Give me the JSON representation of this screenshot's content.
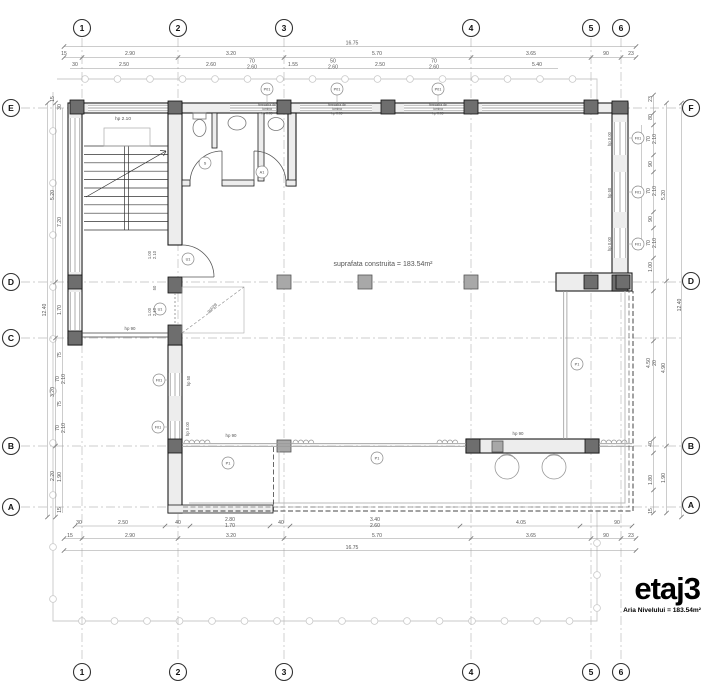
{
  "title_block": {
    "title": "etaj3",
    "subtitle": "Aria Nivelului = 183.54m²"
  },
  "area_note": "suprafata construita = 183.54m²",
  "grid_bubbles": {
    "cols": [
      {
        "label": "1",
        "x": 82
      },
      {
        "label": "2",
        "x": 178
      },
      {
        "label": "3",
        "x": 284
      },
      {
        "label": "4",
        "x": 471
      },
      {
        "label": "5",
        "x": 591
      },
      {
        "label": "6",
        "x": 621
      }
    ],
    "rows_left": [
      {
        "label": "E",
        "y": 108
      },
      {
        "label": "D",
        "y": 282
      },
      {
        "label": "C",
        "y": 338
      },
      {
        "label": "B",
        "y": 446
      },
      {
        "label": "A",
        "y": 507
      }
    ],
    "rows_right": [
      {
        "label": "F",
        "y": 108
      },
      {
        "label": "D",
        "y": 281
      },
      {
        "label": "B",
        "y": 446
      },
      {
        "label": "A",
        "y": 505
      }
    ]
  },
  "dimensions": {
    "top": [
      {
        "t": "16.75",
        "x": 352,
        "y": 44.5
      },
      {
        "t": "15",
        "x": 64,
        "y": 55
      },
      {
        "t": "2.90",
        "x": 130,
        "y": 55
      },
      {
        "t": "3.20",
        "x": 231,
        "y": 55
      },
      {
        "t": "5.70",
        "x": 377,
        "y": 55
      },
      {
        "t": "3.65",
        "x": 531,
        "y": 55
      },
      {
        "t": "90",
        "x": 606,
        "y": 55
      },
      {
        "t": "23",
        "x": 631,
        "y": 55
      },
      {
        "t": "30",
        "x": 75,
        "y": 66
      },
      {
        "t": "2.50",
        "x": 124,
        "y": 66
      },
      {
        "t": "2.60",
        "x": 211,
        "y": 66
      },
      {
        "t": "70",
        "t2": "2.60",
        "x": 252,
        "y": 62.5
      },
      {
        "t": "1.55",
        "x": 293,
        "y": 66
      },
      {
        "t": "50",
        "t2": "2.60",
        "x": 333,
        "y": 62.5
      },
      {
        "t": "2.50",
        "x": 380,
        "y": 66
      },
      {
        "t": "70",
        "t2": "2.60",
        "x": 434,
        "y": 62.5
      },
      {
        "t": "5.40",
        "x": 537,
        "y": 66
      }
    ],
    "bottom": [
      {
        "t": "30",
        "x": 79,
        "y": 524
      },
      {
        "t": "2.50",
        "x": 123,
        "y": 524
      },
      {
        "t": "40",
        "x": 178,
        "y": 524
      },
      {
        "t": "2.80",
        "t2": "1.70",
        "x": 230,
        "y": 521
      },
      {
        "t": "40",
        "x": 281,
        "y": 524
      },
      {
        "t": "3.40",
        "t2": "2.60",
        "x": 375,
        "y": 521
      },
      {
        "t": "4.05",
        "x": 521,
        "y": 524
      },
      {
        "t": "90",
        "x": 617,
        "y": 524
      },
      {
        "t": "15",
        "x": 70,
        "y": 537
      },
      {
        "t": "2.90",
        "x": 130,
        "y": 537
      },
      {
        "t": "3.20",
        "x": 231,
        "y": 537
      },
      {
        "t": "5.70",
        "x": 377,
        "y": 537
      },
      {
        "t": "3.65",
        "x": 531,
        "y": 537
      },
      {
        "t": "90",
        "x": 606,
        "y": 537
      },
      {
        "t": "23",
        "x": 631,
        "y": 537
      },
      {
        "t": "16.75",
        "x": 352,
        "y": 549
      }
    ],
    "left": [
      {
        "t": "12.40",
        "x": 46,
        "y": 310,
        "r": -90
      },
      {
        "t": "5.20",
        "x": 54,
        "y": 195,
        "r": -90
      },
      {
        "t": "3.20",
        "x": 54,
        "y": 392,
        "r": -90
      },
      {
        "t": "2.20",
        "x": 54,
        "y": 476,
        "r": -90
      },
      {
        "t": "15",
        "x": 54,
        "y": 99,
        "r": -90
      },
      {
        "t": "30",
        "x": 61,
        "y": 107,
        "r": -90
      },
      {
        "t": "7.20",
        "x": 61,
        "y": 222,
        "r": -90
      },
      {
        "t": "1.70",
        "x": 61,
        "y": 310,
        "r": -90
      },
      {
        "t": "75",
        "x": 61,
        "y": 355,
        "r": -90
      },
      {
        "t": "70",
        "t2": "2.10",
        "x": 59,
        "y": 379,
        "r": -90
      },
      {
        "t": "75",
        "x": 61,
        "y": 404,
        "r": -90
      },
      {
        "t": "70",
        "t2": "2.10",
        "x": 59,
        "y": 428,
        "r": -90
      },
      {
        "t": "1.90",
        "x": 61,
        "y": 477,
        "r": -90
      },
      {
        "t": "15",
        "x": 61,
        "y": 510,
        "r": -90
      }
    ],
    "right": [
      {
        "t": "12.40",
        "x": 681,
        "y": 305,
        "r": -90
      },
      {
        "t": "5.20",
        "x": 665,
        "y": 195,
        "r": -90
      },
      {
        "t": "4.90",
        "x": 665,
        "y": 368,
        "r": -90
      },
      {
        "t": "1.90",
        "x": 665,
        "y": 478,
        "r": -90
      },
      {
        "t": "3.20",
        "x": 641,
        "y": 192,
        "r": -90
      },
      {
        "t": "23",
        "x": 652,
        "y": 99,
        "r": -90
      },
      {
        "t": "80",
        "x": 652,
        "y": 117,
        "r": -90
      },
      {
        "t": "70",
        "t2": "2.10",
        "x": 650,
        "y": 139,
        "r": -90
      },
      {
        "t": "90",
        "x": 652,
        "y": 164,
        "r": -90
      },
      {
        "t": "70",
        "t2": "2.10",
        "x": 650,
        "y": 191,
        "r": -90
      },
      {
        "t": "90",
        "x": 652,
        "y": 219,
        "r": -90
      },
      {
        "t": "70",
        "t2": "2.10",
        "x": 650,
        "y": 243,
        "r": -90
      },
      {
        "t": "1.00",
        "x": 652,
        "y": 267,
        "r": -90
      },
      {
        "t": "4.50",
        "t2": "20",
        "x": 650,
        "y": 363,
        "r": -90
      },
      {
        "t": "40",
        "x": 652,
        "y": 444,
        "r": -90
      },
      {
        "t": "1.80",
        "x": 652,
        "y": 480,
        "r": -90
      },
      {
        "t": "15",
        "x": 652,
        "y": 511,
        "r": -90
      }
    ]
  },
  "annotations": [
    {
      "t": "hp 2.10",
      "x": 123,
      "y": 120
    },
    {
      "t": "hp 90",
      "x": 130,
      "y": 330,
      "s": 4.4
    },
    {
      "t": "hp 90",
      "x": 231,
      "y": 437,
      "s": 4.4
    },
    {
      "t": "hp 90",
      "x": 518,
      "y": 435,
      "s": 4.4
    },
    {
      "t": "hp 0.00",
      "x": 611,
      "y": 139,
      "r": -90,
      "s": 4.2
    },
    {
      "t": "hp 50",
      "x": 611,
      "y": 193,
      "r": -90,
      "s": 4.2
    },
    {
      "t": "hp 0.00",
      "x": 611,
      "y": 244,
      "r": -90,
      "s": 4.2
    },
    {
      "t": "hp 50",
      "x": 190,
      "y": 381,
      "r": -90,
      "s": 4.2
    },
    {
      "t": "hp 0.00",
      "x": 189,
      "y": 429,
      "r": -90,
      "s": 4.2
    },
    {
      "t": "1.00",
      "t2": "2.10",
      "x": 151,
      "y": 255,
      "r": -90,
      "s": 4.2
    },
    {
      "t": "50",
      "x": 156,
      "y": 288,
      "r": -90,
      "s": 4.2
    },
    {
      "t": "1.00",
      "t2": "2.10",
      "x": 151,
      "y": 312,
      "r": -90,
      "s": 4.2
    },
    {
      "t": "gol/2B",
      "x": 213,
      "y": 309,
      "r": -42,
      "s": 4.2
    },
    {
      "t": "suprafata construita = 183.54m²",
      "x": 383,
      "y": 266,
      "s": 7
    },
    {
      "t": "fereastra de",
      "t2": "lumina",
      "t3": "hp 0.05",
      "x": 267,
      "y": 106,
      "s": 3.3
    },
    {
      "t": "fereastra de",
      "t2": "lumina",
      "t3": "hp 0.05",
      "x": 337,
      "y": 106,
      "s": 3.3
    },
    {
      "t": "fereastra de",
      "t2": "lumina",
      "t3": "hp 0.05",
      "x": 438,
      "y": 106,
      "s": 3.3
    }
  ],
  "tags": [
    {
      "code": "P01",
      "x": 267,
      "y": 89,
      "ld": [
        267,
        95,
        267,
        103
      ]
    },
    {
      "code": "P01",
      "x": 337,
      "y": 89,
      "ld": [
        337,
        95,
        337,
        103
      ]
    },
    {
      "code": "P01",
      "x": 438,
      "y": 89,
      "ld": [
        438,
        95,
        438,
        103
      ]
    },
    {
      "code": "F01",
      "x": 638,
      "y": 138,
      "ld": [
        632,
        138,
        628,
        138
      ]
    },
    {
      "code": "F01",
      "x": 638,
      "y": 192,
      "ld": [
        632,
        192,
        628,
        192
      ]
    },
    {
      "code": "F01",
      "x": 638,
      "y": 244,
      "ld": [
        632,
        244,
        628,
        244
      ]
    },
    {
      "code": "F01",
      "x": 159,
      "y": 380,
      "ld": [
        165,
        380,
        168,
        380
      ]
    },
    {
      "code": "F01",
      "x": 158,
      "y": 427,
      "ld": [
        164,
        427,
        168,
        427
      ]
    },
    {
      "code": "U1",
      "x": 188,
      "y": 259
    },
    {
      "code": "U1",
      "x": 160,
      "y": 309
    },
    {
      "code": "S",
      "x": 205,
      "y": 163
    },
    {
      "code": "A1",
      "x": 262,
      "y": 172
    },
    {
      "code": "P1",
      "x": 228,
      "y": 463
    },
    {
      "code": "P1",
      "x": 377,
      "y": 458
    },
    {
      "code": "P1",
      "x": 577,
      "y": 364
    }
  ]
}
